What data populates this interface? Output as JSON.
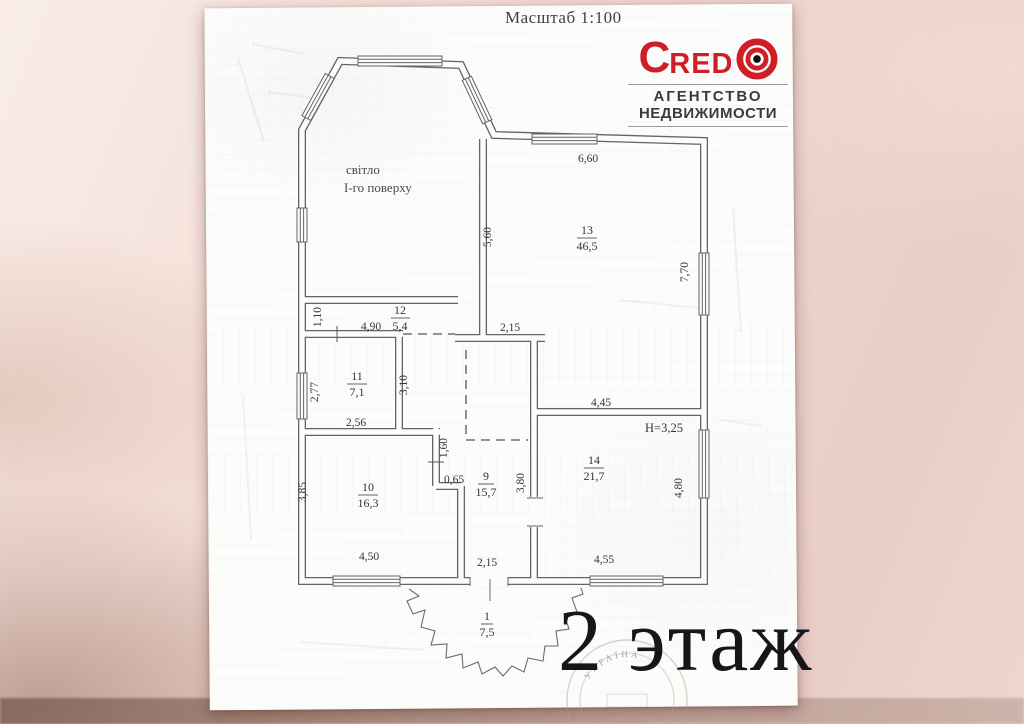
{
  "photo": {
    "scale_note": "Масштаб 1:100",
    "floor_label": "2 этаж"
  },
  "logo": {
    "brand_c": "C",
    "brand_red": "RED",
    "subtitle1": "АГЕНТСТВО",
    "subtitle2": "НЕДВИЖИМОСТИ",
    "accent_color": "#cf1e26"
  },
  "plan": {
    "light_well": {
      "line1": "світло",
      "line2": "І-го поверху"
    },
    "height_note": "H=3,25",
    "stamp_text": "УКРАЇНА",
    "rooms": [
      {
        "number": "13",
        "area": "46,5"
      },
      {
        "number": "12",
        "area": "5,4"
      },
      {
        "number": "11",
        "area": "7,1"
      },
      {
        "number": "10",
        "area": "16,3"
      },
      {
        "number": "9",
        "area": "15,7"
      },
      {
        "number": "14",
        "area": "21,7"
      },
      {
        "number": "1",
        "area": "7,5"
      }
    ],
    "dimensions": {
      "h": [
        {
          "t": "6,60"
        },
        {
          "t": "2,15"
        },
        {
          "t": "4,90"
        },
        {
          "t": "2,56"
        },
        {
          "t": "0,65"
        },
        {
          "t": "4,50"
        },
        {
          "t": "2,15"
        },
        {
          "t": "4,55"
        },
        {
          "t": "4,45"
        }
      ],
      "v": [
        {
          "t": "5,60"
        },
        {
          "t": "7,70"
        },
        {
          "t": "1,10"
        },
        {
          "t": "2,77"
        },
        {
          "t": "3,10"
        },
        {
          "t": "1,60"
        },
        {
          "t": "3,85"
        },
        {
          "t": "3,80"
        },
        {
          "t": "4,80"
        }
      ]
    }
  }
}
